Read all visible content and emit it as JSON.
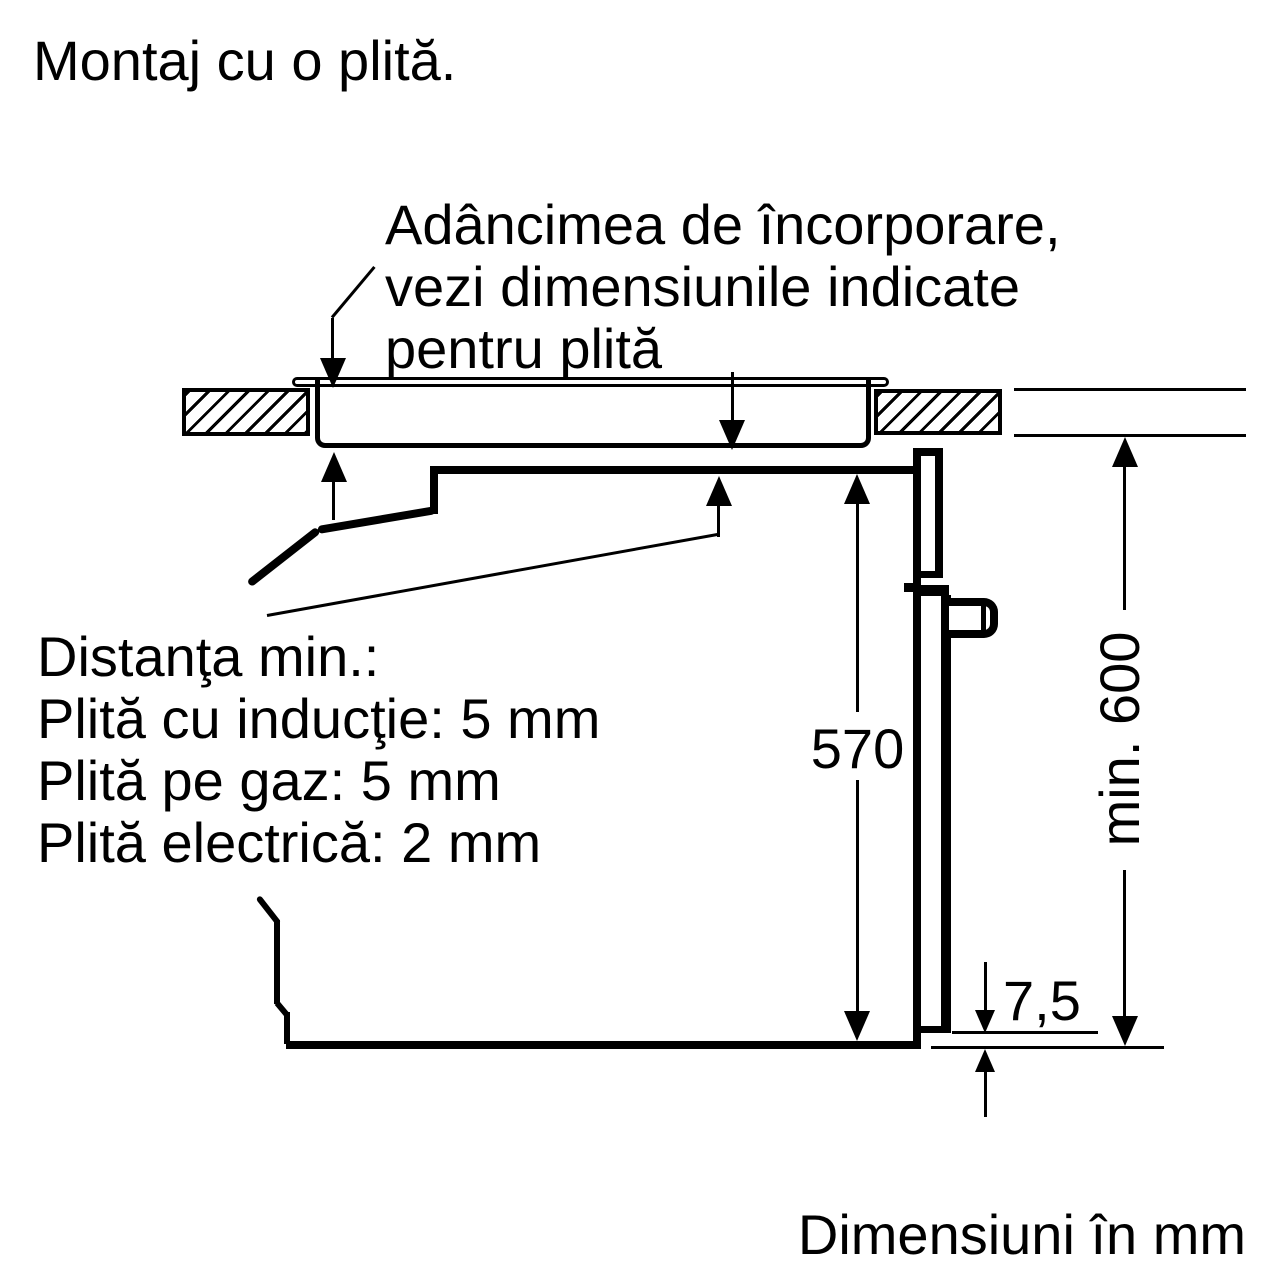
{
  "title": "Montaj cu o plită.",
  "depth_note": {
    "line1": "Adâncimea de încorporare,",
    "line2": "vezi dimensiunile indicate",
    "line3": "pentru plită"
  },
  "distance_note": {
    "line1": "Distanţa min.:",
    "line2": "Plită cu inducţie: 5 mm",
    "line3": "Plită pe gaz: 5 mm",
    "line4": "Plită electrică: 2 mm"
  },
  "dimensions": {
    "niche_height": "570",
    "min_clearance": "min. 600",
    "bottom_gap": "7,5"
  },
  "footer": "Dimensiuni în mm",
  "colors": {
    "line": "#000000",
    "background": "#ffffff"
  }
}
